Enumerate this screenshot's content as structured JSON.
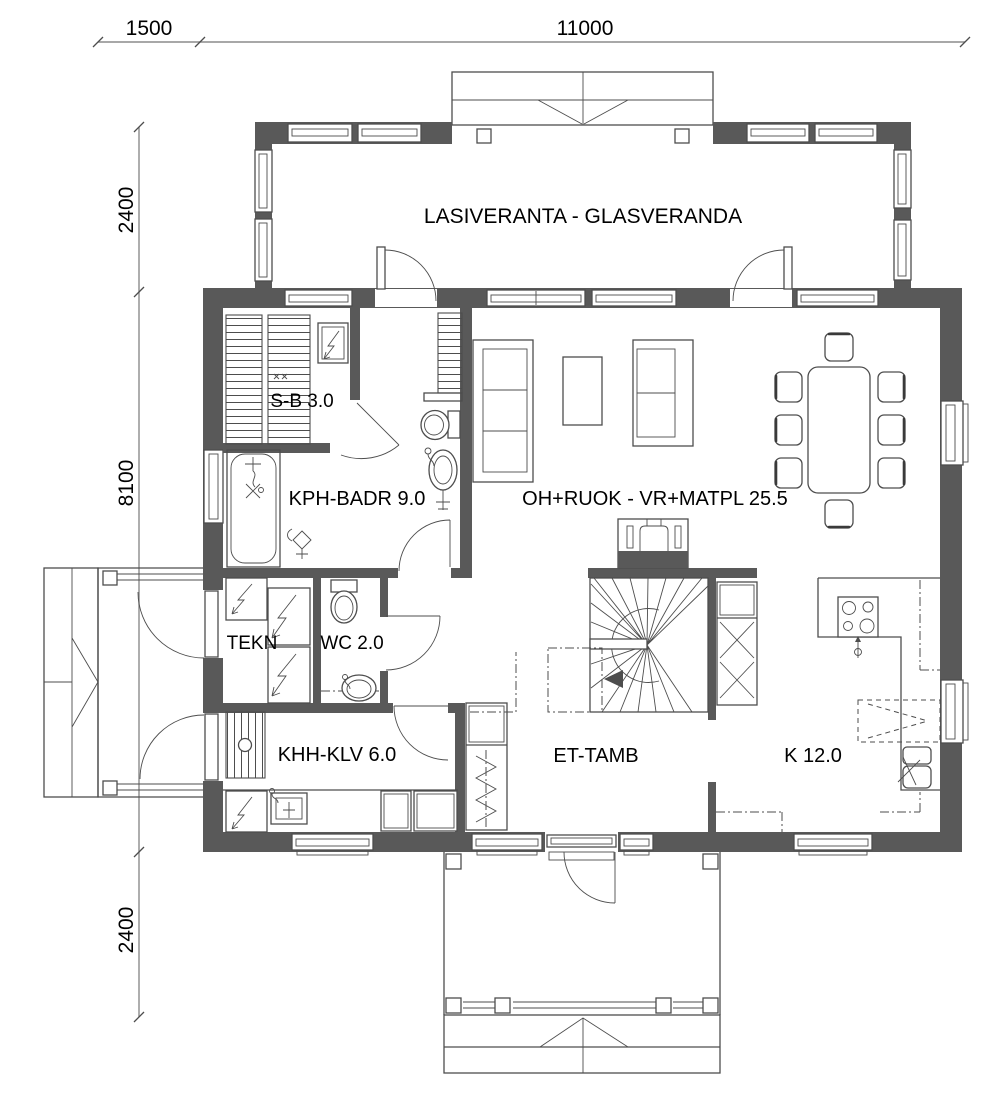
{
  "drawing": {
    "type": "floor-plan",
    "dimensions": {
      "top": [
        "1500",
        "11000"
      ],
      "left": [
        "2400",
        "8100",
        "2400"
      ]
    },
    "rooms": {
      "veranda": "LASIVERANTA - GLASVERANDA",
      "sauna": "S-B 3.0",
      "bathroom": "KPH-BADR 9.0",
      "living_dining": "OH+RUOK - VR+MATPL 25.5",
      "technical": "TEKN",
      "wc": "WC 2.0",
      "utility": "KHH-KLV 6.0",
      "entry": "ET-TAMB",
      "kitchen": "K 12.0"
    },
    "colors": {
      "wall": "#595959",
      "line": "#4d4d4d",
      "dimension_line": "#8c8c8c",
      "text": "#000000",
      "background": "#ffffff"
    }
  }
}
